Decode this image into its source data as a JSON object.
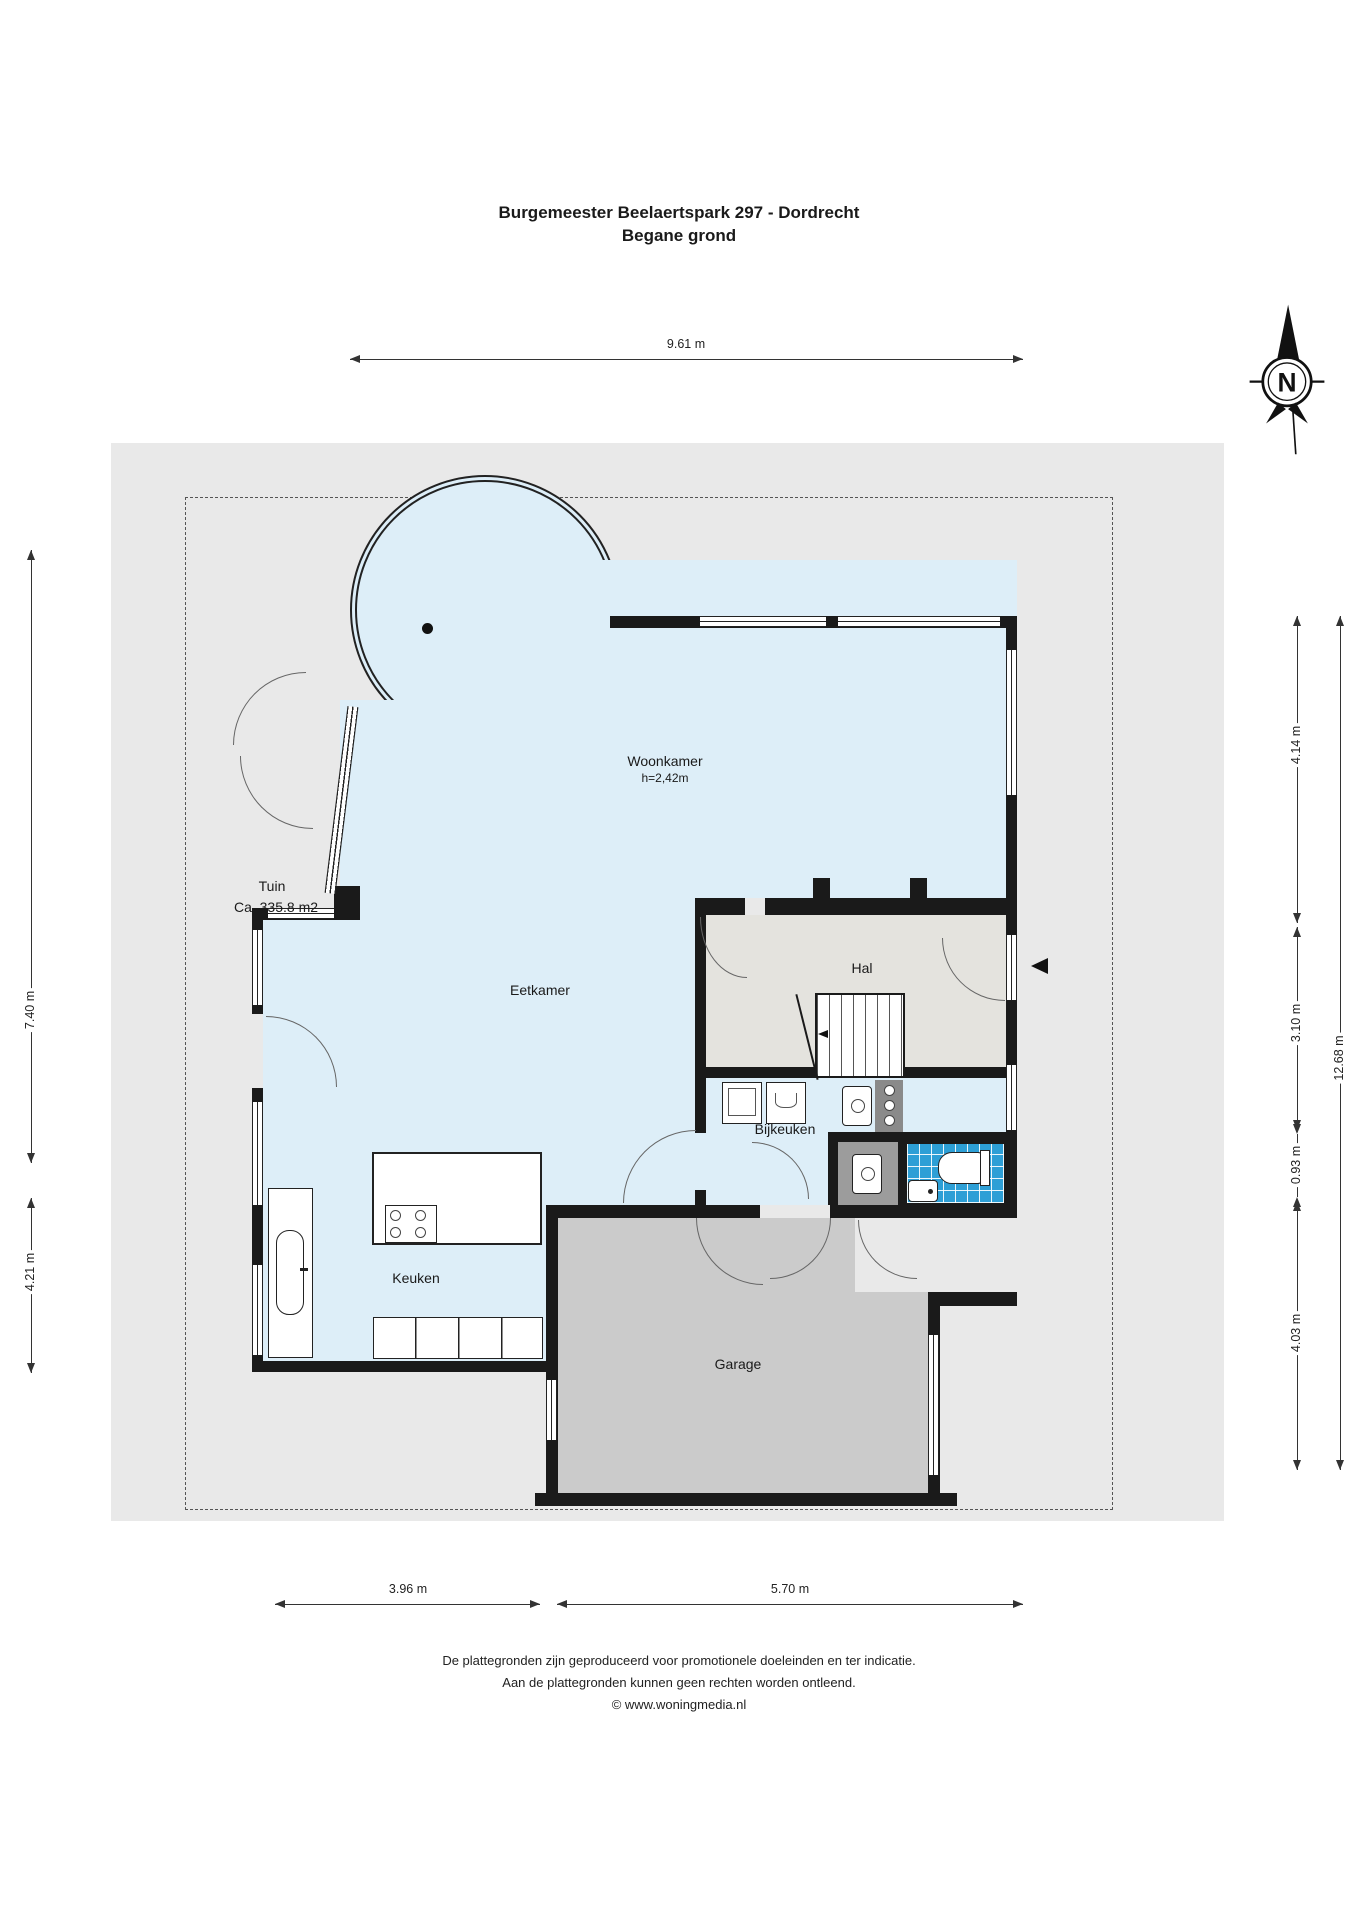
{
  "title": {
    "line1": "Burgemeester Beelaertspark 297 - Dordrecht",
    "line2": "Begane grond"
  },
  "compass": {
    "label": "N"
  },
  "rooms": {
    "woonkamer": {
      "label": "Woonkamer",
      "height_note": "h=2,42m"
    },
    "tuin": {
      "label": "Tuin",
      "area_note": "Ca. 335.8 m2"
    },
    "eetkamer": {
      "label": "Eetkamer"
    },
    "hal": {
      "label": "Hal"
    },
    "bijkeuken": {
      "label": "Bijkeuken"
    },
    "keuken": {
      "label": "Keuken"
    },
    "garage": {
      "label": "Garage"
    }
  },
  "dims": {
    "top_9_61": "9.61 m",
    "left_7_40": "7.40 m",
    "left_4_21": "4.21 m",
    "right_4_14": "4.14 m",
    "right_3_10": "3.10 m",
    "right_0_93": "0.93 m",
    "right_4_03": "4.03 m",
    "right_12_68": "12.68 m",
    "bottom_3_96": "3.96 m",
    "bottom_5_70": "5.70 m"
  },
  "footer": {
    "line1": "De plattegronden zijn geproduceerd voor promotionele doeleinden en ter indicatie.",
    "line2": "Aan de plattegronden kunnen geen rechten worden ontleend.",
    "line3": "© www.woningmedia.nl"
  },
  "colors": {
    "wall": "#1a1a1a",
    "room_blue": "#ddeef8",
    "hal_gray": "#e4e3de",
    "garage_gray": "#cbcbcb",
    "garden_gray": "#e9e9e9",
    "tile_blue": "#2d9fd6"
  }
}
